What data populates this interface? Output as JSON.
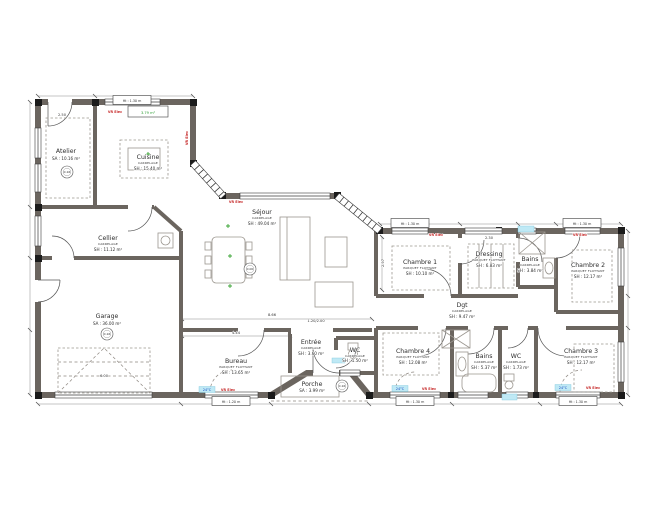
{
  "colors": {
    "wall": "#6b655f",
    "red_annotation": "#c62828",
    "blue_annotation": "#1348c2",
    "green_annotation": "#2f9e35",
    "cyan_highlight": "#bfe9f5"
  },
  "rooms": {
    "atelier": {
      "name": "Atelier",
      "area": "SA : 10.16 m²"
    },
    "cuisine": {
      "name": "Cuisine",
      "material": "CARRELAGE",
      "area": "SH : 15.40 m²"
    },
    "cellier": {
      "name": "Cellier",
      "material": "CARRELAGE",
      "area": "SH : 11.12 m²"
    },
    "garage": {
      "name": "Garage",
      "area": "SA : 36.00 m²"
    },
    "sejour": {
      "name": "Séjour",
      "material": "CARRELAGE",
      "area": "SH : 49.04 m²"
    },
    "entree": {
      "name": "Entrée",
      "material": "CARRELAGE",
      "area": "SH : 3.60 m²"
    },
    "wc1": {
      "name": "WC",
      "material": "CARRELAGE",
      "area": "SH : 1.50 m²"
    },
    "bureau": {
      "name": "Bureau",
      "material": "PARQUET FLOTTANT",
      "area": "SH : 13.65 m²"
    },
    "porche": {
      "name": "Porche",
      "area": "SA : 3.99 m²"
    },
    "chambre1": {
      "name": "Chambre 1",
      "material": "PARQUET FLOTTANT",
      "area": "SH : 10.10 m²"
    },
    "dressing": {
      "name": "Dressing",
      "material": "PARQUET FLOTTANT",
      "area": "SH : 6.83 m²"
    },
    "bains1": {
      "name": "Bains",
      "material": "CARRELAGE",
      "area": "SH : 3.84 m²"
    },
    "chambre2": {
      "name": "Chambre 2",
      "material": "PARQUET FLOTTANT",
      "area": "SH : 12.17 m²"
    },
    "dgt": {
      "name": "Dgt",
      "material": "CARRELAGE",
      "area": "SH : 9.47 m²"
    },
    "chambre4": {
      "name": "Chambre 4",
      "material": "PARQUET FLOTTANT",
      "area": "SH : 12.08 m²"
    },
    "bains2": {
      "name": "Bains",
      "material": "CARRELAGE",
      "area": "SH : 5.37 m²"
    },
    "wc2": {
      "name": "WC",
      "material": "CARRELAGE",
      "area": "SH : 1.73 m²"
    },
    "chambre3": {
      "name": "Chambre 3",
      "material": "PARQUET FLOTTANT",
      "area": "SH : 12.17 m²"
    }
  },
  "green_tag": "3.79 m²",
  "dim_labels": [
    {
      "t": "2.50",
      "x": 62,
      "y": 116
    },
    {
      "t": "6.00",
      "x": 104,
      "y": 377
    },
    {
      "t": "8.66",
      "x": 272,
      "y": 316
    },
    {
      "t": "4.44",
      "x": 236,
      "y": 334
    },
    {
      "t": "1.20/2.00",
      "x": 316,
      "y": 322
    },
    {
      "t": "2.30",
      "x": 489,
      "y": 239
    },
    {
      "t": "2.97",
      "x": 384,
      "y": 263,
      "rot": -90
    }
  ],
  "red_tags": [
    {
      "t": "VR Elec",
      "x": 115,
      "y": 113
    },
    {
      "t": "VR Elec",
      "x": 188,
      "y": 138,
      "rot": -90
    },
    {
      "t": "VR Elec",
      "x": 236,
      "y": 203
    },
    {
      "t": "VR Elec",
      "x": 436,
      "y": 236
    },
    {
      "t": "VR Elec",
      "x": 580,
      "y": 236
    },
    {
      "t": "VR Elec",
      "x": 228,
      "y": 391
    },
    {
      "t": "VR Elec",
      "x": 429,
      "y": 390
    },
    {
      "t": "VR Elec",
      "x": 593,
      "y": 389
    }
  ],
  "blue_tags": [
    {
      "t": "24°C",
      "x": 207,
      "y": 391
    },
    {
      "t": "24°C",
      "x": 400,
      "y": 390
    },
    {
      "t": "24°C",
      "x": 563,
      "y": 389
    }
  ],
  "window_boxes": [
    {
      "t": "Ht : 1.30 m",
      "x": 132,
      "y": 100
    },
    {
      "t": "Ht : 1.30 m",
      "x": 410,
      "y": 223
    },
    {
      "t": "Ht : 1.30 m",
      "x": 582,
      "y": 223
    },
    {
      "t": "Ht : 1.20 m",
      "x": 231,
      "y": 401
    },
    {
      "t": "Ht : 1.30 m",
      "x": 415,
      "y": 401
    },
    {
      "t": "Ht : 1.30 m",
      "x": 578,
      "y": 401
    }
  ],
  "level_markers": [
    {
      "t": "0.16",
      "x": 67,
      "y": 172
    },
    {
      "t": "0.16",
      "x": 107,
      "y": 334
    },
    {
      "t": "0.00",
      "x": 250,
      "y": 269
    },
    {
      "t": "0.16",
      "x": 342,
      "y": 386
    }
  ]
}
